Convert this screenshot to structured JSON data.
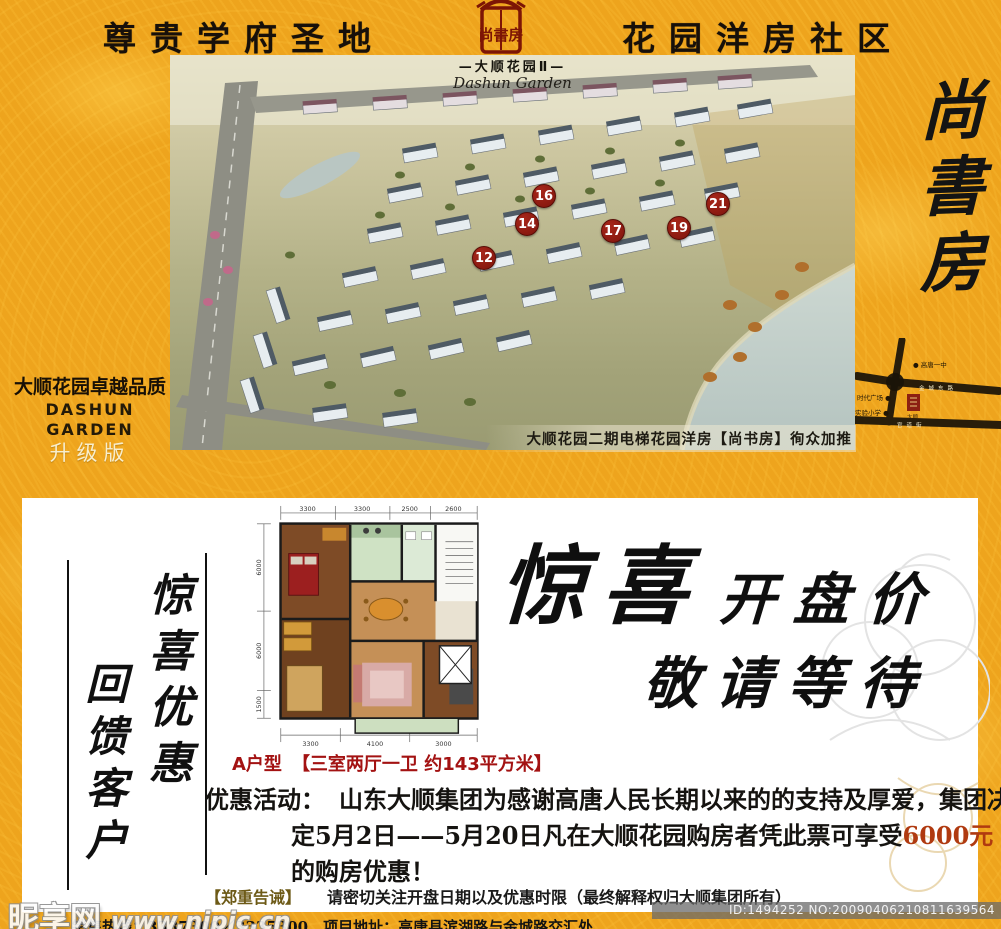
{
  "colors": {
    "gold": "#eea41d",
    "seal_red": "#7d1505",
    "marker_red": "#8c1a10",
    "accent_red": "#a31212",
    "highlight_red": "#b03a10"
  },
  "header": {
    "left_title": "尊贵学府圣地",
    "right_title": "花园洋房社区",
    "seal_text": "尚書房"
  },
  "aerial": {
    "title_cn": "—大顺花园Ⅱ—",
    "title_en": "Dashun Garden",
    "caption": "大顺花园二期电梯花园洋房【尚书房】徇众加推",
    "markers": [
      {
        "number": "12"
      },
      {
        "number": "14"
      },
      {
        "number": "16"
      },
      {
        "number": "17"
      },
      {
        "number": "19"
      },
      {
        "number": "21"
      }
    ]
  },
  "brand_block": {
    "line1": "大顺花园卓越品质",
    "line2": "DASHUN GARDEN",
    "line3": "升级版"
  },
  "side_column": {
    "calligraphy": "尚書房",
    "map": {
      "poi_top": "● 高唐一中",
      "road_cross": "金城东路",
      "poi_left1": "时代广场 ●",
      "poi_left2": "实验小学 ●",
      "road_bottom": "官道街",
      "seal_caption": "大顺"
    }
  },
  "coupon": {
    "vertical_right": "惊喜优惠",
    "vertical_left": "回馈客户",
    "floorplan": {
      "dims_top": [
        "3300",
        "3300",
        "2500",
        "2600"
      ],
      "dims_left": [
        "6000",
        "6000",
        "1500"
      ],
      "dims_bottom": [
        "3300",
        "4100",
        "3000"
      ],
      "type_label": "A户型",
      "spec_label": "【三室两厅一卫  约143平方米】"
    },
    "headline": {
      "word_big": "惊喜",
      "word_rest": "开盘价",
      "line2": "敬请等待"
    },
    "promo": {
      "label": "优惠活动：",
      "line1": "山东大顺集团为感谢高唐人民长期以来的的支持及厚爱，集团决",
      "line2_pre": "定5月2日——5月20日凡在大顺花园购房者凭此票可享受",
      "line2_highlight": "6000元",
      "line3": "的购房优惠！"
    },
    "notice": {
      "label": "【郑重告诫】",
      "text": "请密切关注开盘日期以及优惠时限（最终解释权归大顺集团所有）"
    }
  },
  "footer": {
    "partial_line": "销售热线：3337300／3335300　项目地址：高唐县滨湖路与金城路交汇处",
    "watermark_site": "昵享网",
    "watermark_url": "www.nipic.cn",
    "id_text": "ID:1494252 NO:20090406210811639564"
  }
}
